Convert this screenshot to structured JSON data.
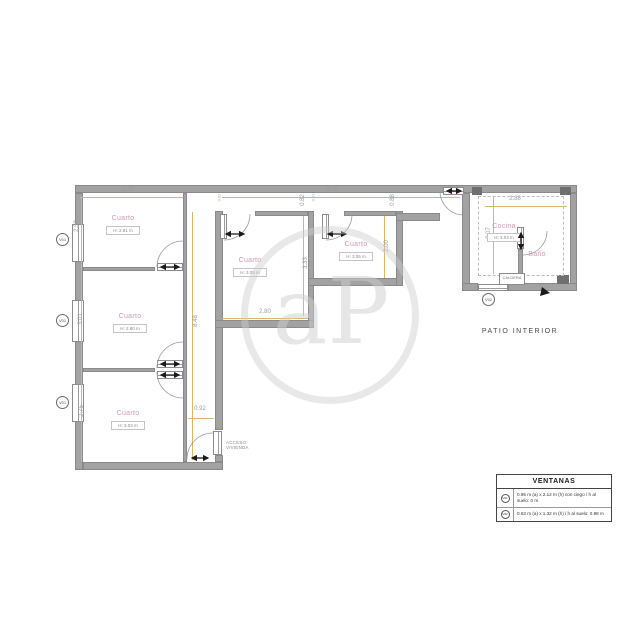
{
  "watermark": {
    "letters": "aP"
  },
  "rooms": [
    {
      "name": "Cuarto",
      "height": "H: 2.81 m"
    },
    {
      "name": "Cuarto",
      "height": "H: 2.80 m"
    },
    {
      "name": "Cuarto",
      "height": "H: 3.03 m"
    },
    {
      "name": "Cuarto",
      "height": "H: 3.05 m"
    },
    {
      "name": "Cuarto",
      "height": "H: 3.05 m"
    },
    {
      "name": "Cocina",
      "height": "H: 3.04 m"
    },
    {
      "name": "Baño"
    }
  ],
  "dims": {
    "room1_top": "3.18",
    "room1_left": "2.58",
    "room2_left": "3.01",
    "room3_left": "2.75",
    "hall_height": "8.48",
    "hall_width": "0.92",
    "room4_bottom": "2.80",
    "room4_right": "3.33",
    "room5_right": "2.00",
    "strip_top": "8.78",
    "strip_height_left": "0.82",
    "strip_height_right": "0.88",
    "kitchen_top": "2.88",
    "kitchen_left": "3.07",
    "stub_a": "0.62",
    "stub_b": "0.61",
    "door_height": "H: 2.13 m"
  },
  "windows": {
    "v01": "V01",
    "v02": "V02"
  },
  "labels": {
    "patio": "PATIO INTERIOR",
    "acceso_line1": "ACCESO",
    "acceso_line2": "VIVIENDA",
    "caldera": "CALDERA"
  },
  "legend": {
    "title": "VENTANAS",
    "rows": [
      {
        "code": "V01",
        "desc": "0.95 m (a) x 2.12 m (h) con ciego / h al suelo: 0 m"
      },
      {
        "code": "V02",
        "desc": "0.63 m (a) x 1.32 m (h) / h al suelo: 0.98 m"
      }
    ]
  }
}
